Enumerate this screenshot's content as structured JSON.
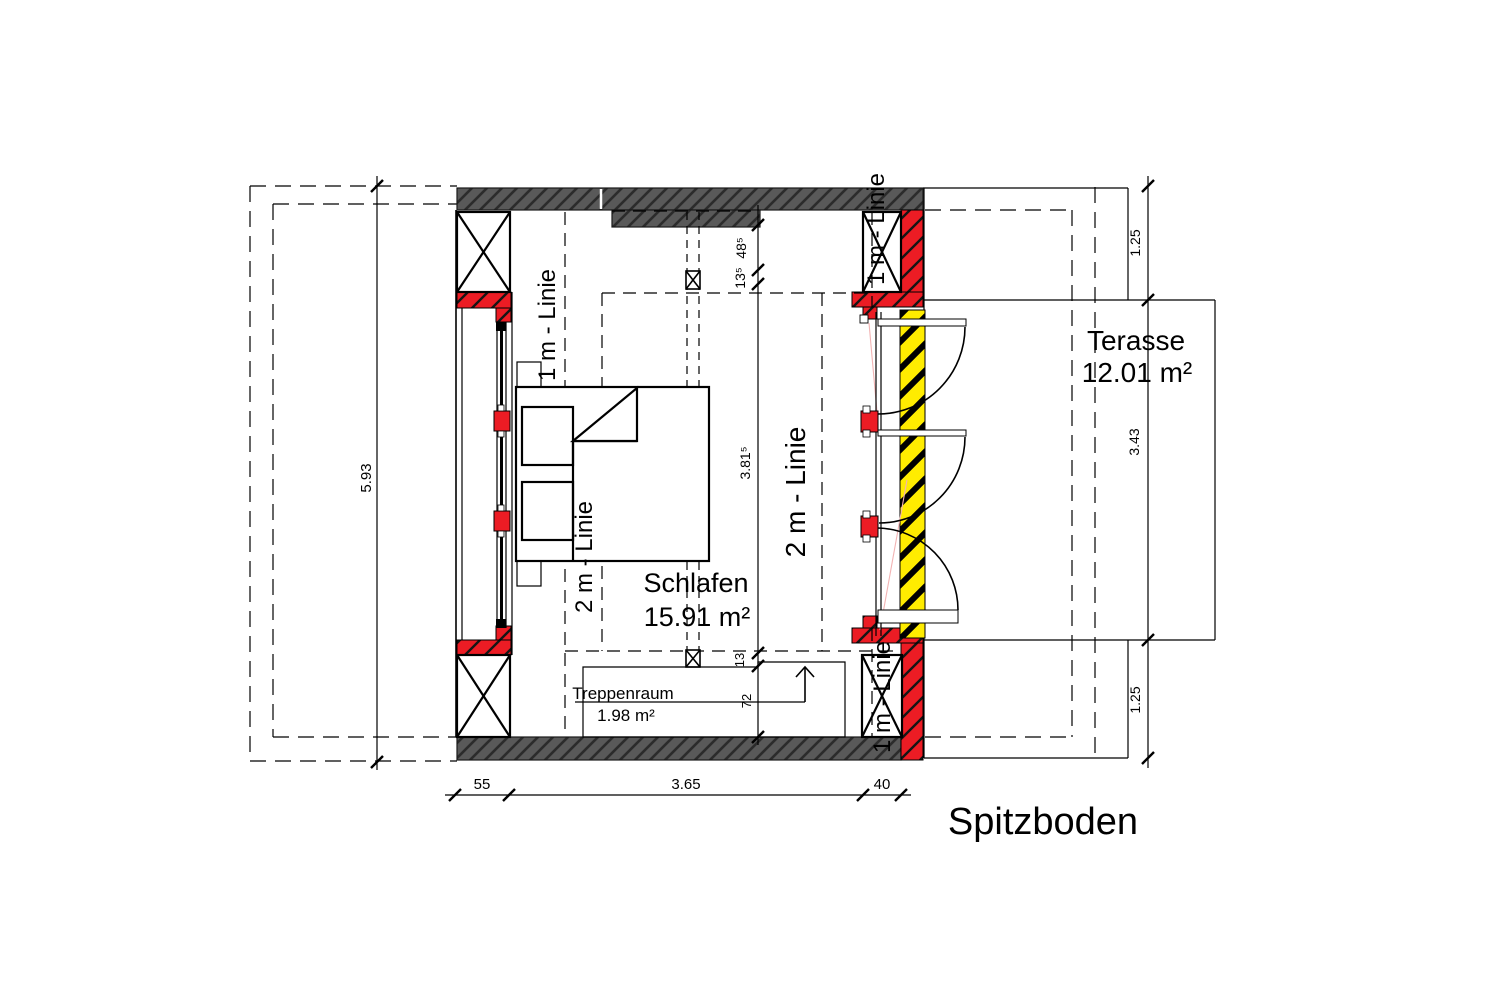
{
  "title": "Spitzboden",
  "rooms": {
    "schlafen": {
      "name": "Schlafen",
      "area": "15.91 m²"
    },
    "terasse": {
      "name": "Terasse",
      "area": "12.01 m²"
    },
    "treppenraum": {
      "name": "Treppenraum",
      "area": "1.98 m²"
    }
  },
  "guide_lines": {
    "one_m_left": "1 m - Linie",
    "one_m_top_right": "1 m - Linie",
    "one_m_bottom_right": "1 m - Linie",
    "two_m_left": "2 m - Linie",
    "two_m_right": "2 m - Linie"
  },
  "dimensions": {
    "left_total": "5.93",
    "right_top": "1.25",
    "right_middle": "3.43",
    "right_bottom": "1.25",
    "top_segment_1": "48⁵",
    "top_segment_2": "13⁵",
    "room_depth": "3.81⁵",
    "stair_offset": "13",
    "stair_width": "72",
    "bottom_segment_1": "55",
    "bottom_segment_2": "3.65",
    "bottom_segment_3": "40"
  },
  "colors": {
    "wall_fill": "#595959",
    "accent_red": "#ec1c24",
    "accent_yellow": "#ffec00",
    "line": "#000000"
  }
}
